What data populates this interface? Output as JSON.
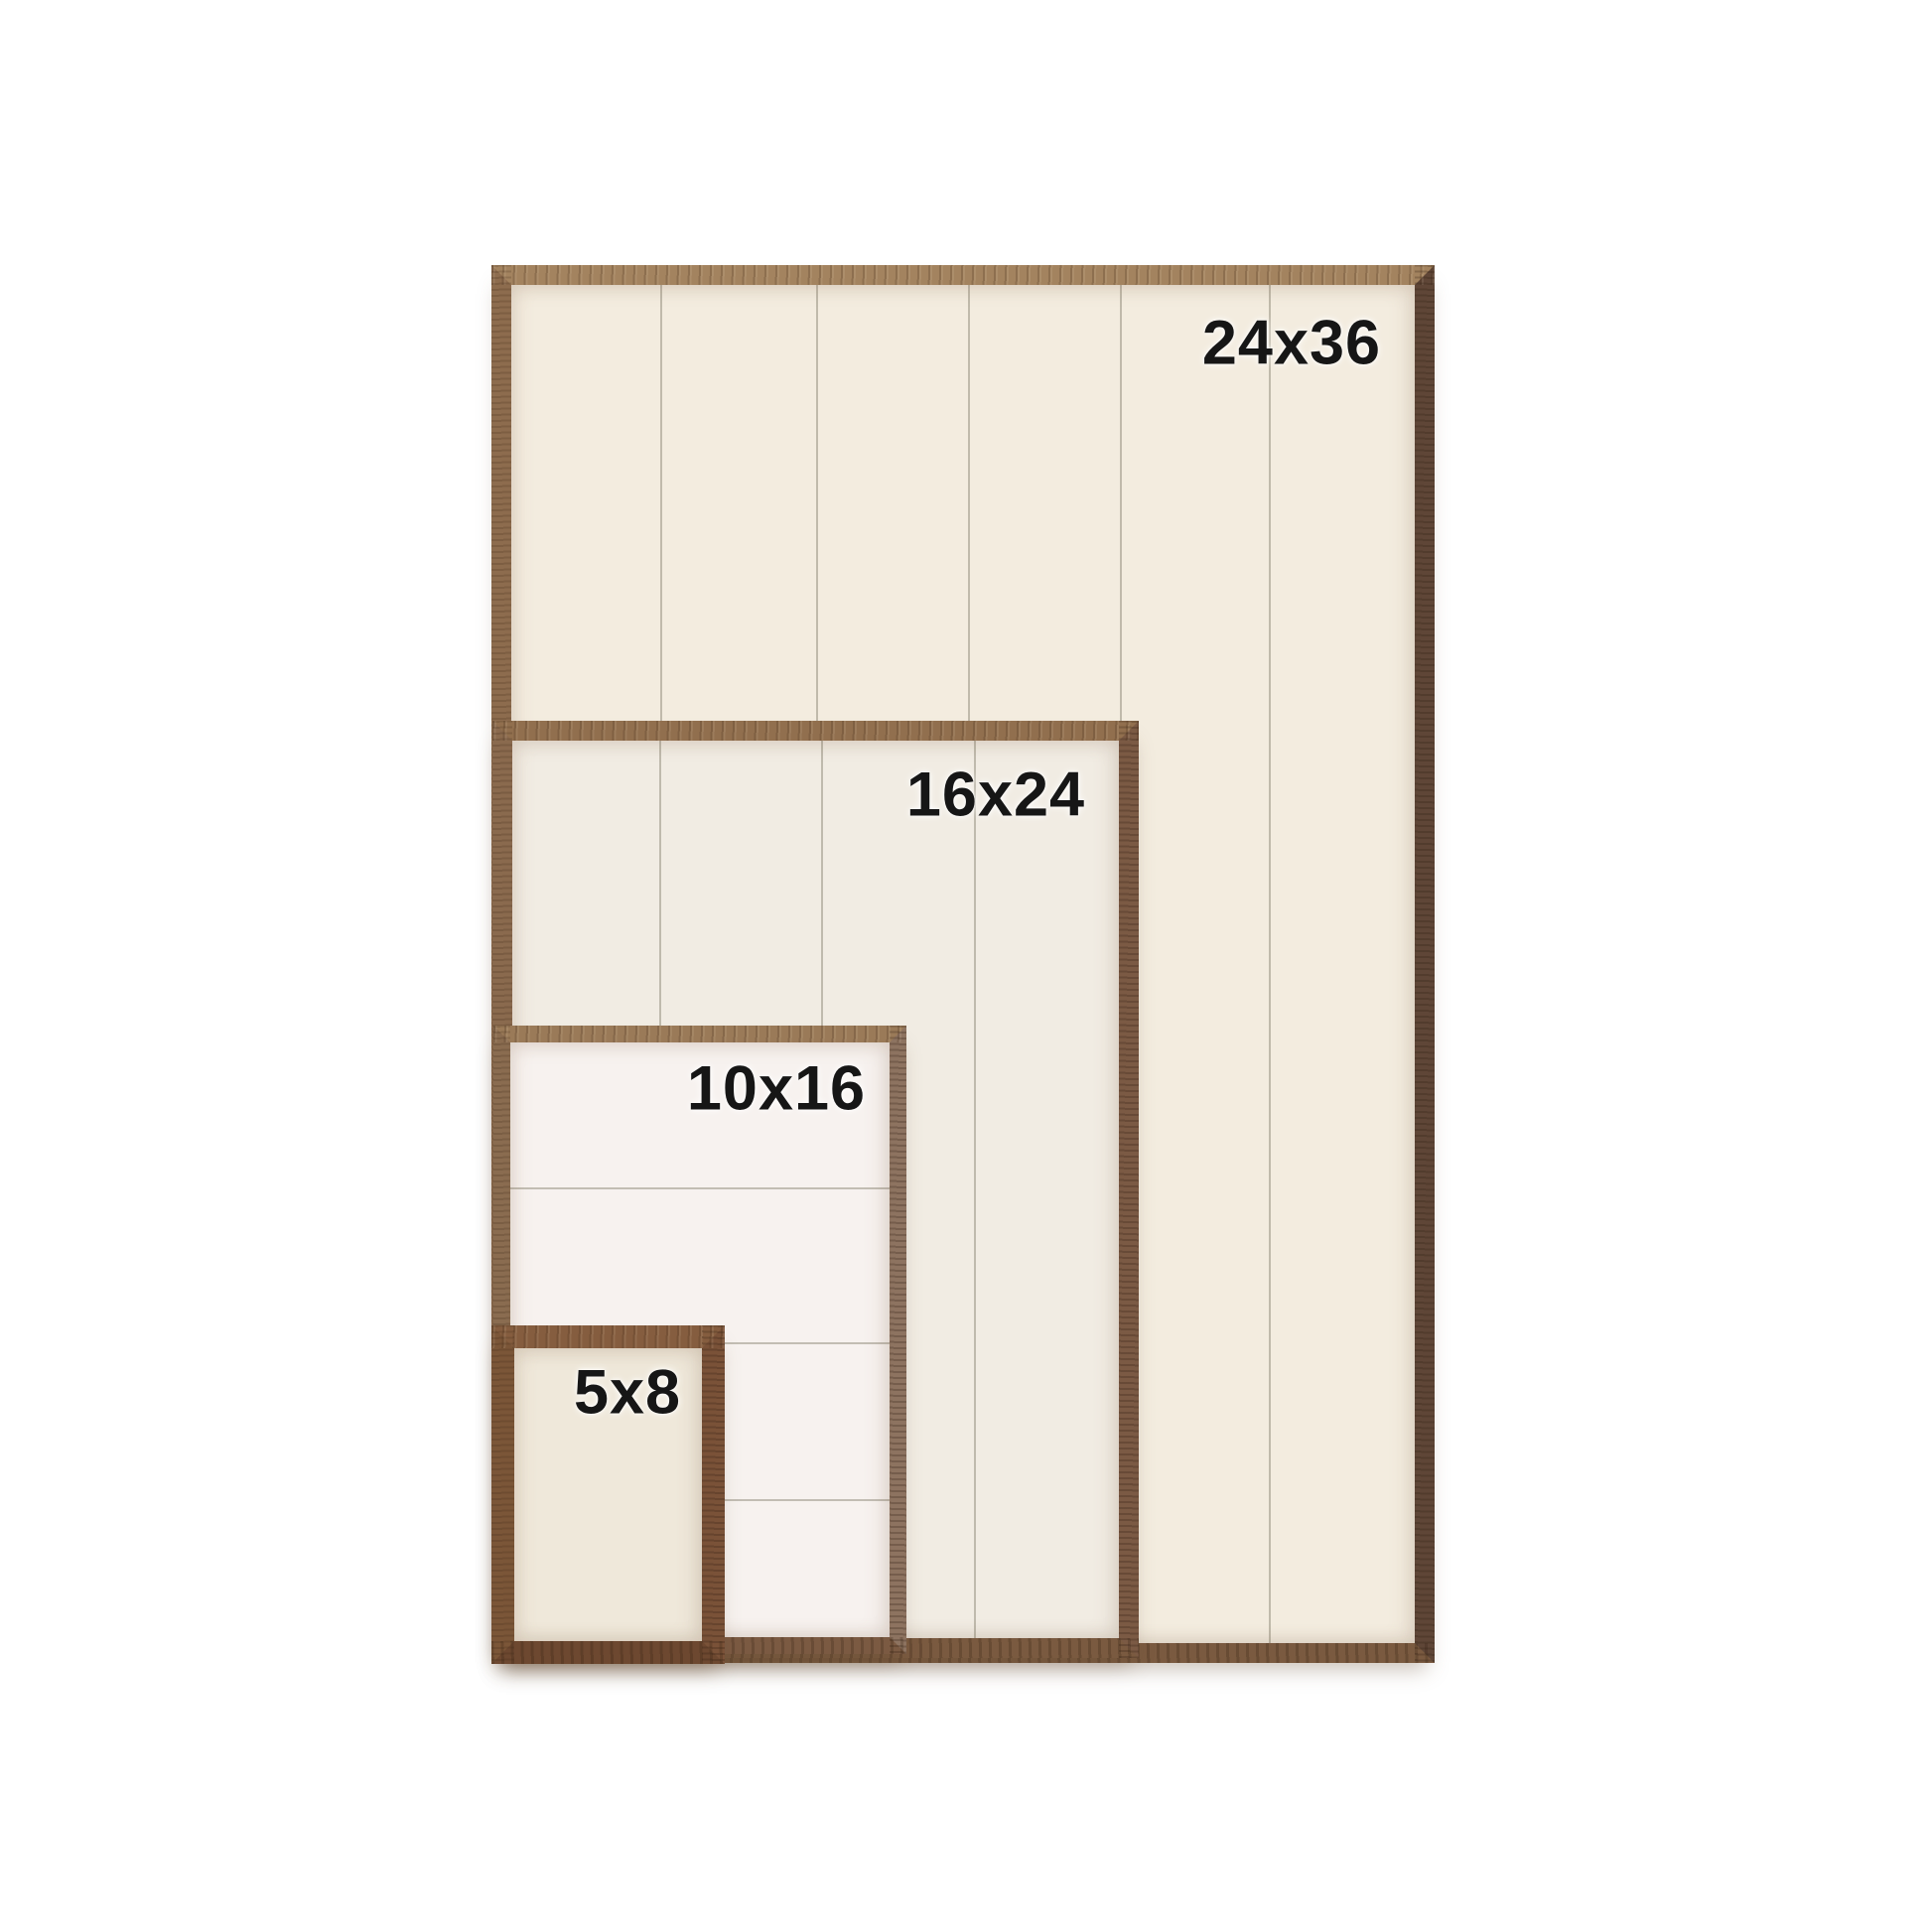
{
  "page": {
    "background_color": "#ffffff"
  },
  "labels": {
    "color": "#161616"
  },
  "frames": [
    {
      "label": "24x36",
      "size_inches": {
        "width": 24,
        "height": 36
      },
      "panel_color": "#f3ecdf",
      "wood_colors": {
        "top": "#a3835f",
        "left": "#8d6c4e",
        "right": "#5f4637",
        "bottom": "#7a5a40"
      },
      "planks": {
        "orientation": "vertical",
        "count": 6,
        "seams_pct": [
          16.6,
          33.8,
          50.7,
          67.5,
          84.0
        ]
      }
    },
    {
      "label": "16x24",
      "size_inches": {
        "width": 16,
        "height": 24
      },
      "panel_color": "#f1ece3",
      "wood_colors": {
        "top": "#916f4e",
        "left": "#8a6a4e",
        "right": "#7b5a44",
        "bottom": "#7a5a40"
      },
      "planks": {
        "orientation": "vertical",
        "count": 4,
        "seams_pct": [
          24.4,
          51.1,
          76.3
        ]
      }
    },
    {
      "label": "10x16",
      "size_inches": {
        "width": 10,
        "height": 16
      },
      "panel_color": "#f7f2ef",
      "wood_colors": {
        "top": "#9a7a58",
        "left": "#8a6c50",
        "right": "#8d7360",
        "bottom": "#7b5a42"
      },
      "planks": {
        "orientation": "horizontal",
        "count": 4,
        "seams_pct": [
          24.5,
          50.6,
          77.0
        ]
      }
    },
    {
      "label": "5x8",
      "size_inches": {
        "width": 5,
        "height": 8
      },
      "panel_color": "#efe8da",
      "wood_colors": {
        "top": "#855d3f",
        "left": "#7b5638",
        "right": "#7a5238",
        "bottom": "#6d4830"
      },
      "planks": {
        "orientation": "none",
        "count": 1,
        "seams_pct": []
      }
    }
  ]
}
